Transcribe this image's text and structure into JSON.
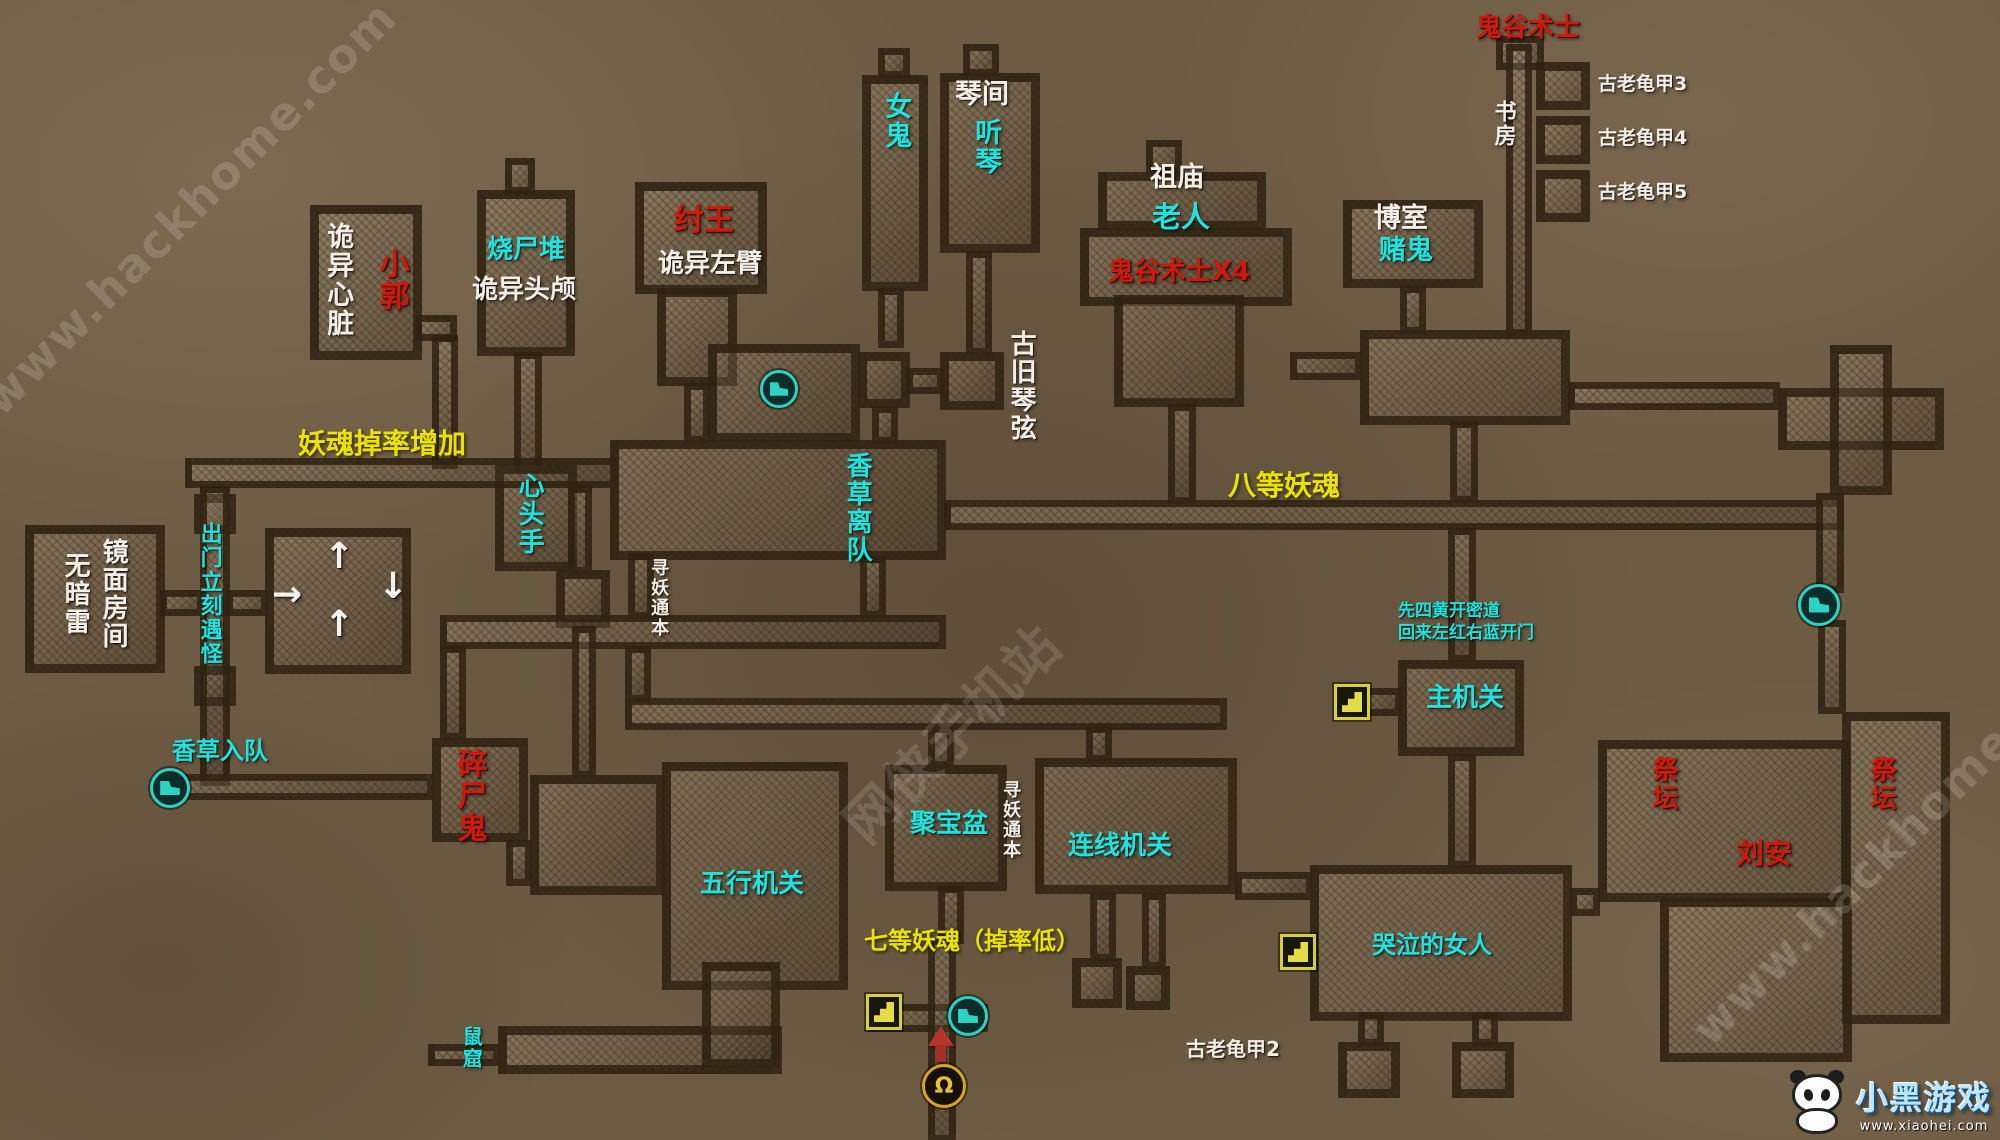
{
  "labels": {
    "weird_heart": {
      "text": "诡异心脏",
      "color": "white"
    },
    "xiao_guo": {
      "text": "小郭",
      "color": "red"
    },
    "corpse_pyre": {
      "text": "烧尸堆",
      "color": "cyan"
    },
    "weird_skull": {
      "text": "诡异头颅",
      "color": "white"
    },
    "king_zhou": {
      "text": "纣王",
      "color": "red"
    },
    "weird_left_arm": {
      "text": "诡异左臂",
      "color": "white"
    },
    "female_ghost": {
      "text": "女鬼",
      "color": "cyan"
    },
    "qin_chamber": {
      "text": "琴间",
      "color": "white"
    },
    "listen_qin": {
      "text": "听琴",
      "color": "cyan"
    },
    "ancestral_temple": {
      "text": "祖庙",
      "color": "white"
    },
    "old_man": {
      "text": "老人",
      "color": "cyan"
    },
    "guigu_x4": {
      "text": "鬼谷术士X4",
      "color": "red"
    },
    "gamble_room": {
      "text": "博室",
      "color": "white"
    },
    "gamble_ghost": {
      "text": "赌鬼",
      "color": "cyan"
    },
    "guigu_warlock": {
      "text": "鬼谷术士",
      "color": "red"
    },
    "study": {
      "text": "书房",
      "color": "white"
    },
    "turtle3": {
      "text": "古老龟甲3",
      "color": "white"
    },
    "turtle4": {
      "text": "古老龟甲4",
      "color": "white"
    },
    "turtle5": {
      "text": "古老龟甲5",
      "color": "white"
    },
    "old_qin_string": {
      "text": "古旧琴弦",
      "color": "white"
    },
    "soul_drop_up": {
      "text": "妖魂掉率增加",
      "color": "yellow"
    },
    "heart_head_hand": {
      "text": "心头手",
      "color": "cyan"
    },
    "herb_leave": {
      "text": "香草离队",
      "color": "cyan"
    },
    "soul8": {
      "text": "八等妖魂",
      "color": "yellow"
    },
    "mirror_room": {
      "text": "镜面房间",
      "color": "white"
    },
    "no_mine": {
      "text": "无暗雷",
      "color": "white"
    },
    "exit_monster": {
      "text": "出门立刻遇怪",
      "color": "cyan"
    },
    "seek_book1": {
      "text": "寻妖通本",
      "color": "white"
    },
    "herb_join": {
      "text": "香草入队",
      "color": "cyan"
    },
    "shredder_ghost": {
      "text": "碎尸鬼",
      "color": "red"
    },
    "five_elements": {
      "text": "五行机关",
      "color": "cyan"
    },
    "treasure_bowl": {
      "text": "聚宝盆",
      "color": "cyan"
    },
    "seek_book2": {
      "text": "寻妖通本",
      "color": "white"
    },
    "wire_puzzle": {
      "text": "连线机关",
      "color": "cyan"
    },
    "soul7": {
      "text": "七等妖魂（掉率低）",
      "color": "yellow"
    },
    "note_line1": {
      "text": "先四黄开密道",
      "color": "cyan"
    },
    "note_line2": {
      "text": "回来左红右蓝开门",
      "color": "cyan"
    },
    "main_switch": {
      "text": "主机关",
      "color": "cyan"
    },
    "crying_woman": {
      "text": "哭泣的女人",
      "color": "cyan"
    },
    "turtle2": {
      "text": "古老龟甲2",
      "color": "white"
    },
    "rat_hole": {
      "text": "鼠窟",
      "color": "cyan"
    },
    "altar_left": {
      "text": "祭坛",
      "color": "red"
    },
    "liu_an": {
      "text": "刘安",
      "color": "red"
    },
    "altar_right": {
      "text": "祭坛",
      "color": "red"
    }
  },
  "arrows": {
    "up": "↑",
    "right": "→",
    "down": "↓"
  },
  "icons": {
    "walk_marker": "boot-marker",
    "switch_marker": "hand-switch",
    "spawn_arrow": "red-up-arrow",
    "magnet_glyph": "Ω"
  },
  "watermarks": {
    "site": "www.hackhome.com",
    "cn_site": "网侠手机站"
  },
  "logo": {
    "brand": "小黑游戏",
    "site": "www.xiaohei.com"
  },
  "colors": {
    "label_white": "#f3efe6",
    "label_cyan": "#1fe3df",
    "label_red": "#cc1a0e",
    "label_yellow": "#eae300",
    "room_fill": "#a09074",
    "room_outline": "#2e2110",
    "background": "#6d5b43",
    "icon_teal": "#2bd3c3",
    "icon_yellow": "#d6cf3a",
    "icon_red": "#b5342a",
    "icon_orange": "#d9a520"
  }
}
